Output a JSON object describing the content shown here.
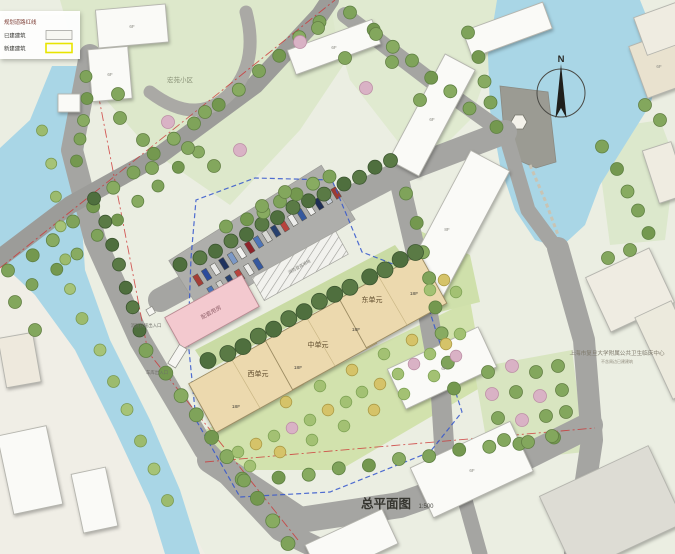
{
  "legend": {
    "items": [
      {
        "label": "规划道路红线"
      },
      {
        "label": "已建建筑"
      },
      {
        "label": "新建建筑"
      }
    ]
  },
  "compass": {
    "north_label": "N"
  },
  "title": {
    "text": "总平面图",
    "scale": "1:500"
  },
  "annotations": {
    "neighborhood": "宏苑小区",
    "hospital_name": "上海市复旦大学附属公共卫生临床中心",
    "hospital_subtitle": "不含周边已建建筑",
    "aux_building": "配套用房",
    "fire_access_area": "消防登高场地",
    "fire_entrance": "消防救援出入口",
    "garage_entrance": "车库出入口"
  },
  "new_building": {
    "units": [
      {
        "label": "西单元"
      },
      {
        "label": "中单元"
      },
      {
        "label": "东单元"
      }
    ],
    "floor_marks": [
      "18F",
      "18F",
      "18F",
      "18F"
    ]
  },
  "existing_floor_marks": [
    "6F",
    "6F",
    "6F",
    "6F",
    "8F",
    "6F",
    "6F",
    "6F"
  ],
  "colors": {
    "new_building": "#ecd9ae",
    "aux_building": "#f3c9cf",
    "water": "#a9d6e6",
    "road": "#a5a5a2",
    "boundary": "#3355cc",
    "redline": "#cc3333",
    "legend_new_border": "#e8e400"
  }
}
